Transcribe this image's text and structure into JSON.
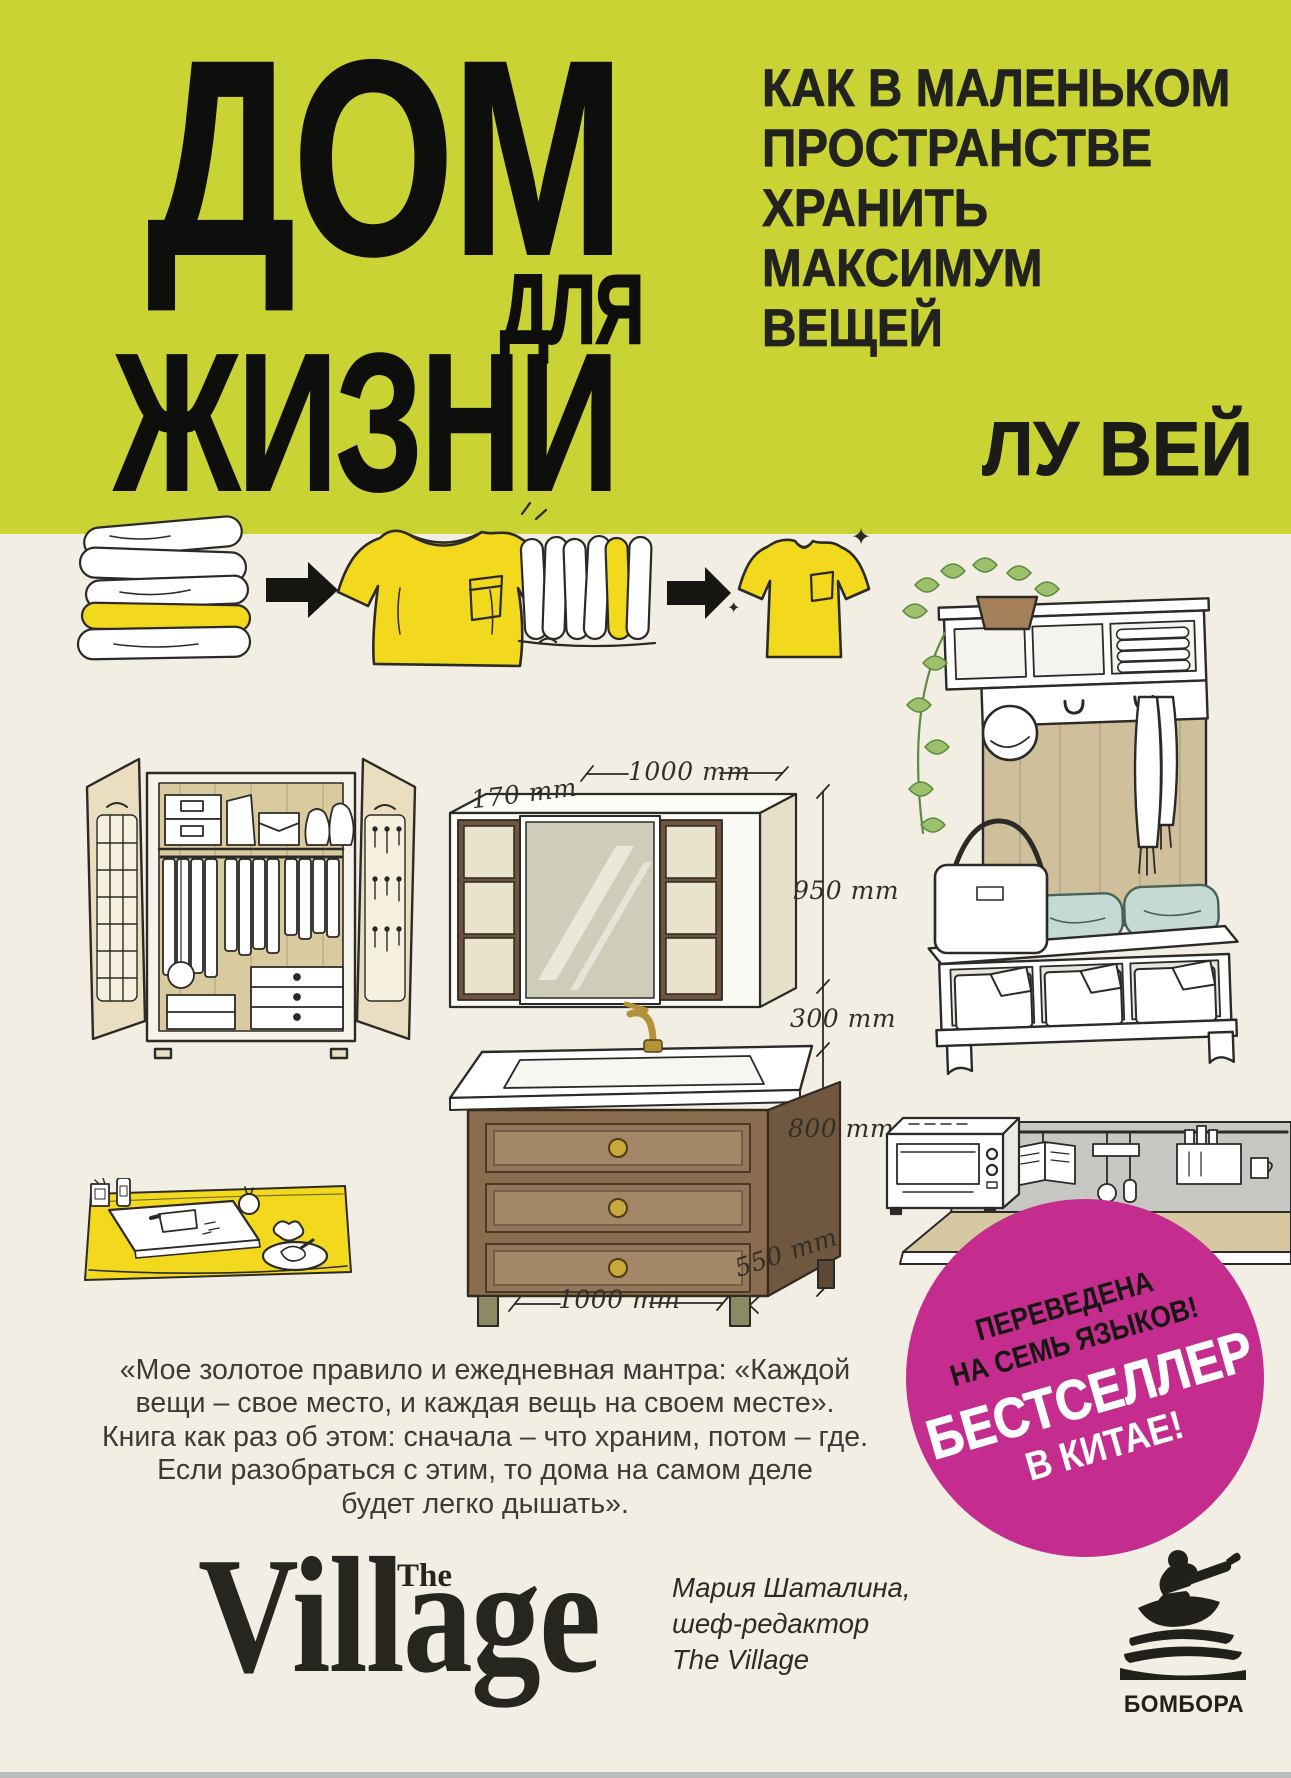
{
  "header": {
    "title_line1": "ДОМ",
    "title_line2": "ДЛЯ",
    "title_line3": "ЖИЗНИ",
    "subtitle_lines": [
      "КАК В МАЛЕНЬКОМ",
      "ПРОСТРАНСТВЕ",
      "ХРАНИТЬ",
      "МАКСИМУМ",
      "ВЕЩЕЙ"
    ],
    "author": "ЛУ ВЕЙ"
  },
  "colors": {
    "band_green": "#c9d334",
    "background_cream": "#f2eee4",
    "badge_pink": "#c42d8e",
    "accent_yellow": "#f2d91e",
    "ink": "#2b2a26"
  },
  "diagram_labels": {
    "depth_top": "170 mm",
    "width_top": "1000 mm",
    "cabinet_height": "950 mm",
    "gap_height": "300 mm",
    "vanity_height": "800 mm",
    "depth_bottom": "550 mm",
    "width_bottom": "1000 mm"
  },
  "quote": {
    "lines": [
      "«Мое золотое правило и ежедневная мантра: «Каждой",
      "вещи – свое место, и каждая вещь на своем месте».",
      "Книга как раз об этом: сначала – что храним, потом – где.",
      "Если разобраться с этим, то дома на самом деле",
      "будет легко дышать»."
    ]
  },
  "endorsement": {
    "logo_main": "Village",
    "logo_the": "The",
    "person": "Мария Шаталина,",
    "role": "шеф-редактор",
    "organization": "The Village"
  },
  "badge": {
    "line1": "ПЕРЕВЕДЕНА",
    "line2": "НА СЕМЬ ЯЗЫКОВ!",
    "line3": "БЕСТСЕЛЛЕР",
    "line4": "В КИТАЕ!"
  },
  "publisher": {
    "name": "БОМБОРА"
  },
  "icons": {
    "sparkle": "✦"
  }
}
